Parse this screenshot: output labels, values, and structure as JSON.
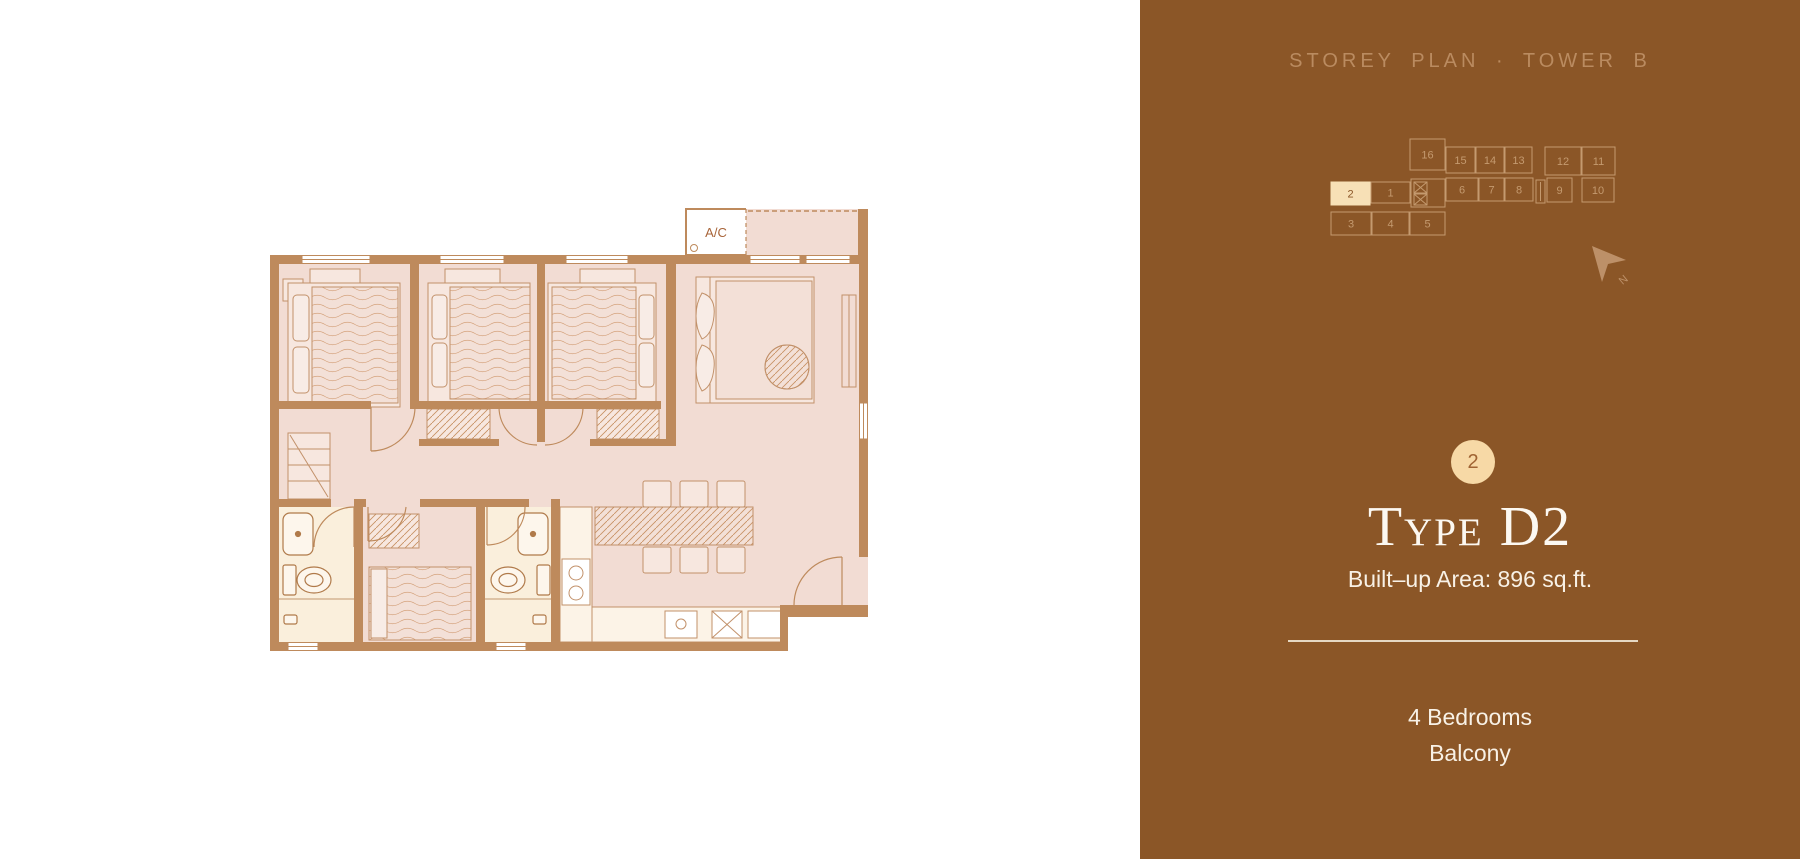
{
  "panel": {
    "title": "STOREY PLAN · TOWER B",
    "selected_unit": "2",
    "type_name": "Type D2",
    "built_up": "Built–up Area: 896 sq.ft.",
    "features": [
      "4 Bedrooms",
      "Balcony"
    ],
    "north_label": "N"
  },
  "minimap": {
    "units": [
      {
        "label": "16",
        "x": 82,
        "y": 15,
        "w": 35,
        "h": 31
      },
      {
        "label": "15",
        "x": 118,
        "y": 23,
        "w": 29,
        "h": 26
      },
      {
        "label": "14",
        "x": 148,
        "y": 23,
        "w": 28,
        "h": 26
      },
      {
        "label": "13",
        "x": 177,
        "y": 23,
        "w": 27,
        "h": 26
      },
      {
        "label": "12",
        "x": 217,
        "y": 23,
        "w": 36,
        "h": 28
      },
      {
        "label": "11",
        "x": 254,
        "y": 23,
        "w": 33,
        "h": 28
      },
      {
        "label": "2",
        "x": 3,
        "y": 58,
        "w": 39,
        "h": 23,
        "selected": true
      },
      {
        "label": "1",
        "x": 43,
        "y": 58,
        "w": 39,
        "h": 21
      },
      {
        "label": "6",
        "x": 118,
        "y": 54,
        "w": 32,
        "h": 23
      },
      {
        "label": "7",
        "x": 151,
        "y": 54,
        "w": 25,
        "h": 23
      },
      {
        "label": "8",
        "x": 177,
        "y": 54,
        "w": 28,
        "h": 23
      },
      {
        "label": "9",
        "x": 219,
        "y": 54,
        "w": 25,
        "h": 24
      },
      {
        "label": "10",
        "x": 254,
        "y": 54,
        "w": 32,
        "h": 24
      },
      {
        "label": "3",
        "x": 3,
        "y": 88,
        "w": 40,
        "h": 23
      },
      {
        "label": "4",
        "x": 44,
        "y": 88,
        "w": 37,
        "h": 23
      },
      {
        "label": "5",
        "x": 82,
        "y": 88,
        "w": 35,
        "h": 23
      }
    ]
  },
  "floorplan": {
    "ac_label": "A/C"
  },
  "colors": {
    "panel_bg": "#8B5627",
    "panel_text": "#F8F1E6",
    "accent_cream": "#F7D9A6",
    "minimap_line": "#C49A6F",
    "wall": "#BE8A5C",
    "floor": "#F2DCD3",
    "bathroom_floor": "#FAEFDC"
  }
}
